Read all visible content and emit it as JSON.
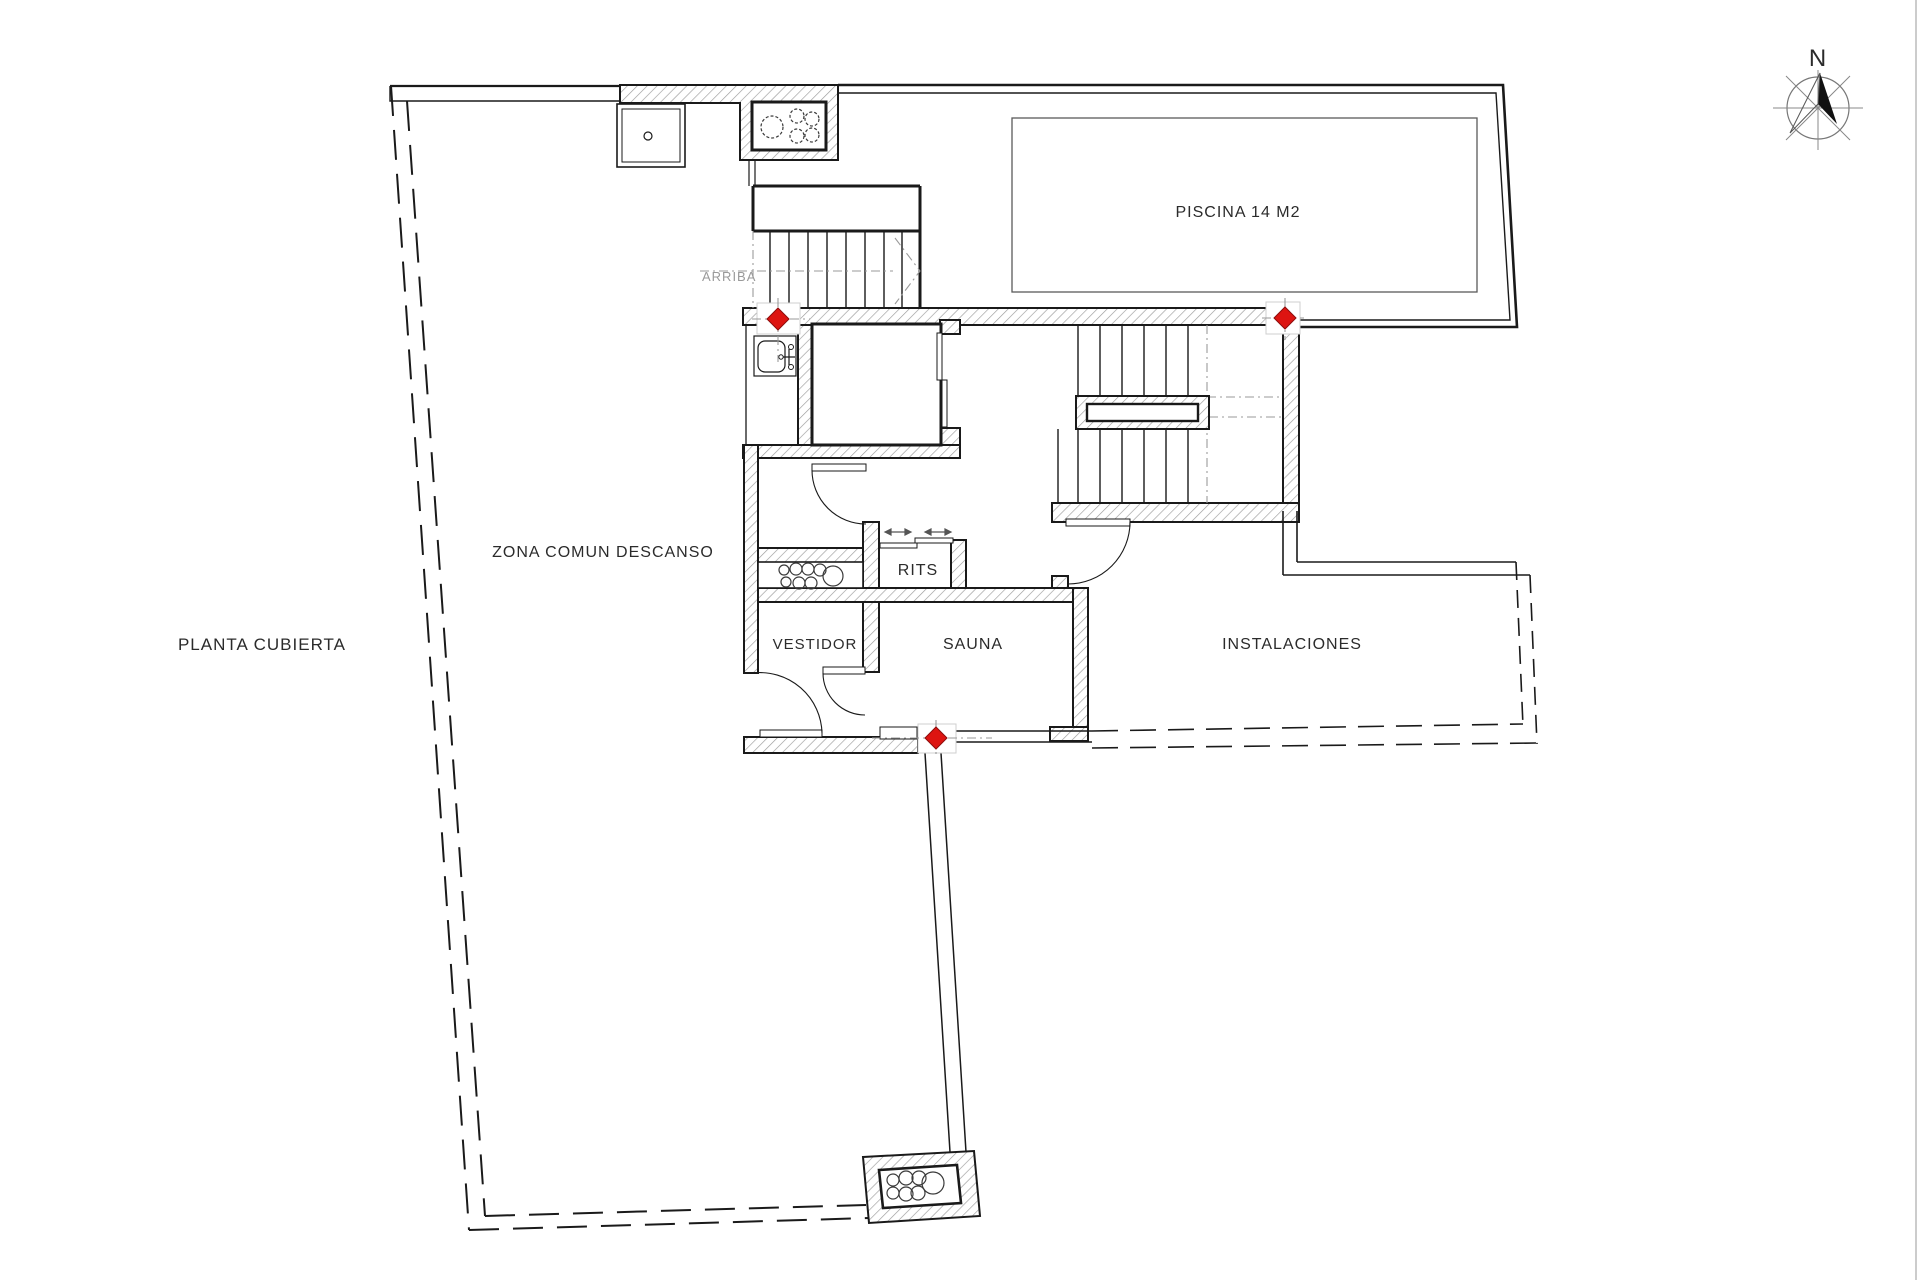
{
  "plan": {
    "title": "PLANTA CUBIERTA",
    "areas": {
      "zona_comun": "ZONA COMUN DESCANSO",
      "piscina": "PISCINA 14 M2",
      "rits": "RITS",
      "vestidor": "VESTIDOR",
      "sauna": "SAUNA",
      "instalaciones": "INSTALACIONES"
    },
    "annotations": {
      "arriba": "ARRIBA",
      "compass_north": "N"
    },
    "colors": {
      "background": "#ffffff",
      "line": "#1a1a1a",
      "hatch": "#9c9c9c",
      "muted": "#9a9a9a",
      "marker_red": "#dd1411"
    },
    "icons": {
      "compass": "compass-rose-icon",
      "level_marker": "red-diamond-icon",
      "vent_pipes": "pipe-circle-cluster-icon",
      "sink": "sink-icon",
      "shower": "shower-tray-icon",
      "stairs_direction": "arrow-icon",
      "sliding_door": "double-arrow-icon"
    }
  }
}
